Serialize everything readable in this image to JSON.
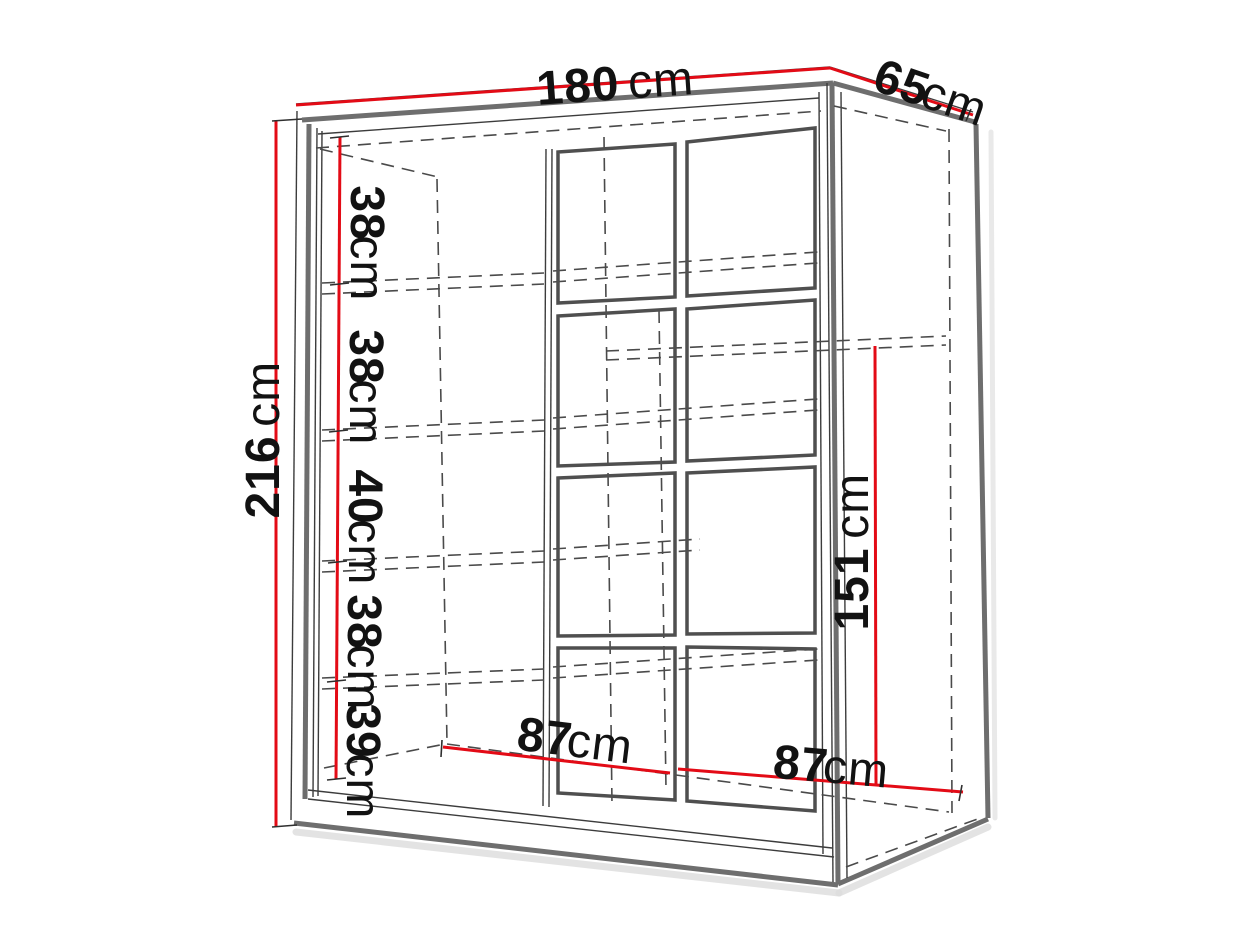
{
  "figure": {
    "type": "furniture-dimension-diagram",
    "subject": "wardrobe",
    "labels": {
      "width": {
        "value": "180",
        "unit": "cm"
      },
      "depth": {
        "value": "65",
        "unit": "cm"
      },
      "height": {
        "value": "216",
        "unit": "cm"
      },
      "inner_width_left": {
        "value": "87",
        "unit": "cm"
      },
      "inner_width_right": {
        "value": "87",
        "unit": "cm"
      },
      "inner_height_right": {
        "value": "151",
        "unit": "cm"
      },
      "shelf_spacings": [
        {
          "value": "38",
          "unit": "cm"
        },
        {
          "value": "38",
          "unit": "cm"
        },
        {
          "value": "40",
          "unit": "cm"
        },
        {
          "value": "38",
          "unit": "cm"
        },
        {
          "value": "39",
          "unit": "cm"
        }
      ]
    },
    "colors": {
      "dimension": "#e30b16",
      "outline": "#3c3c3c",
      "edge": "#6e6e6e",
      "text": "#121212",
      "background": "#ffffff"
    }
  }
}
